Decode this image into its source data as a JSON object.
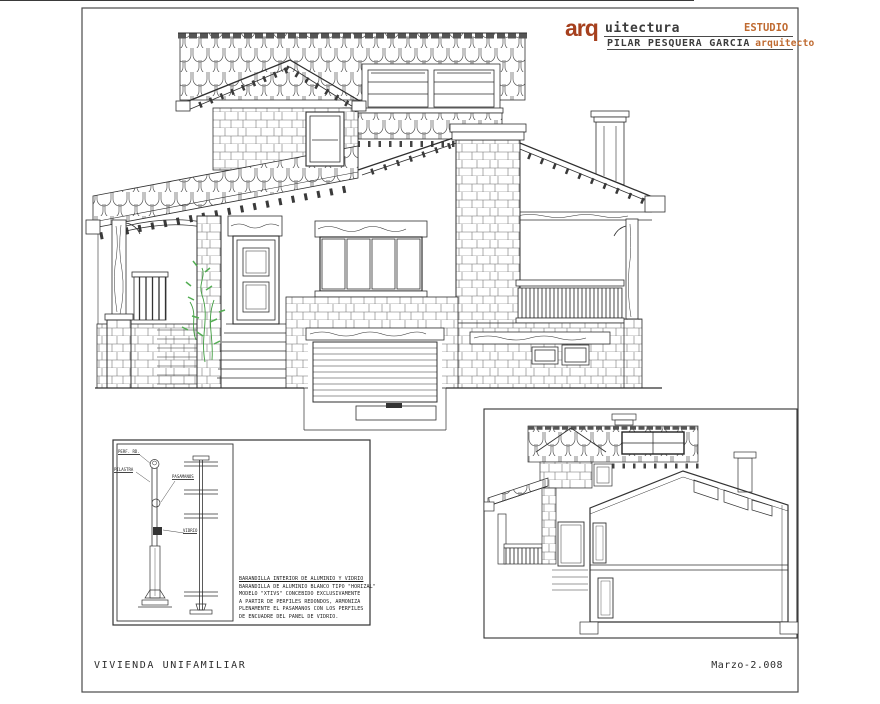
{
  "header": {
    "logo_prefix": "arq",
    "logo_rest": "uitectura",
    "studio": "ESTUDIO",
    "architect": "PILAR PESQUERA GARCIA",
    "architect_role": "arquitecto"
  },
  "footer": {
    "project": "VIVIENDA UNIFAMILIAR",
    "date": "Marzo-2.008"
  },
  "detail": {
    "callouts": [
      "PERF. RD.",
      "PILASTRA",
      "PASAMANOS",
      "VIDRIO"
    ],
    "notes": [
      "BARANDILLA INTERIOR DE ALUMINIO Y VIDRIO",
      "BARANDILLA DE ALUMINIO BLANCO TIPO \"HORIZAL\"",
      "MODELO \"XTIVS\" CONCEBIDO EXCLUSIVAMENTE",
      "A PARTIR DE PERFILES REDONDOS, ARMONIZA",
      "PLENAMENTE EL PASAMANOS CON LOS PERFILES",
      "DE ENCUADRE DEL PANEL DE VIDRIO."
    ]
  },
  "colors": {
    "accent": "#a6401e",
    "accent_light": "#bf6a30",
    "ink": "#3c3c3c",
    "line": "#2f2f2f",
    "plant_green": "#3f9c3f"
  }
}
